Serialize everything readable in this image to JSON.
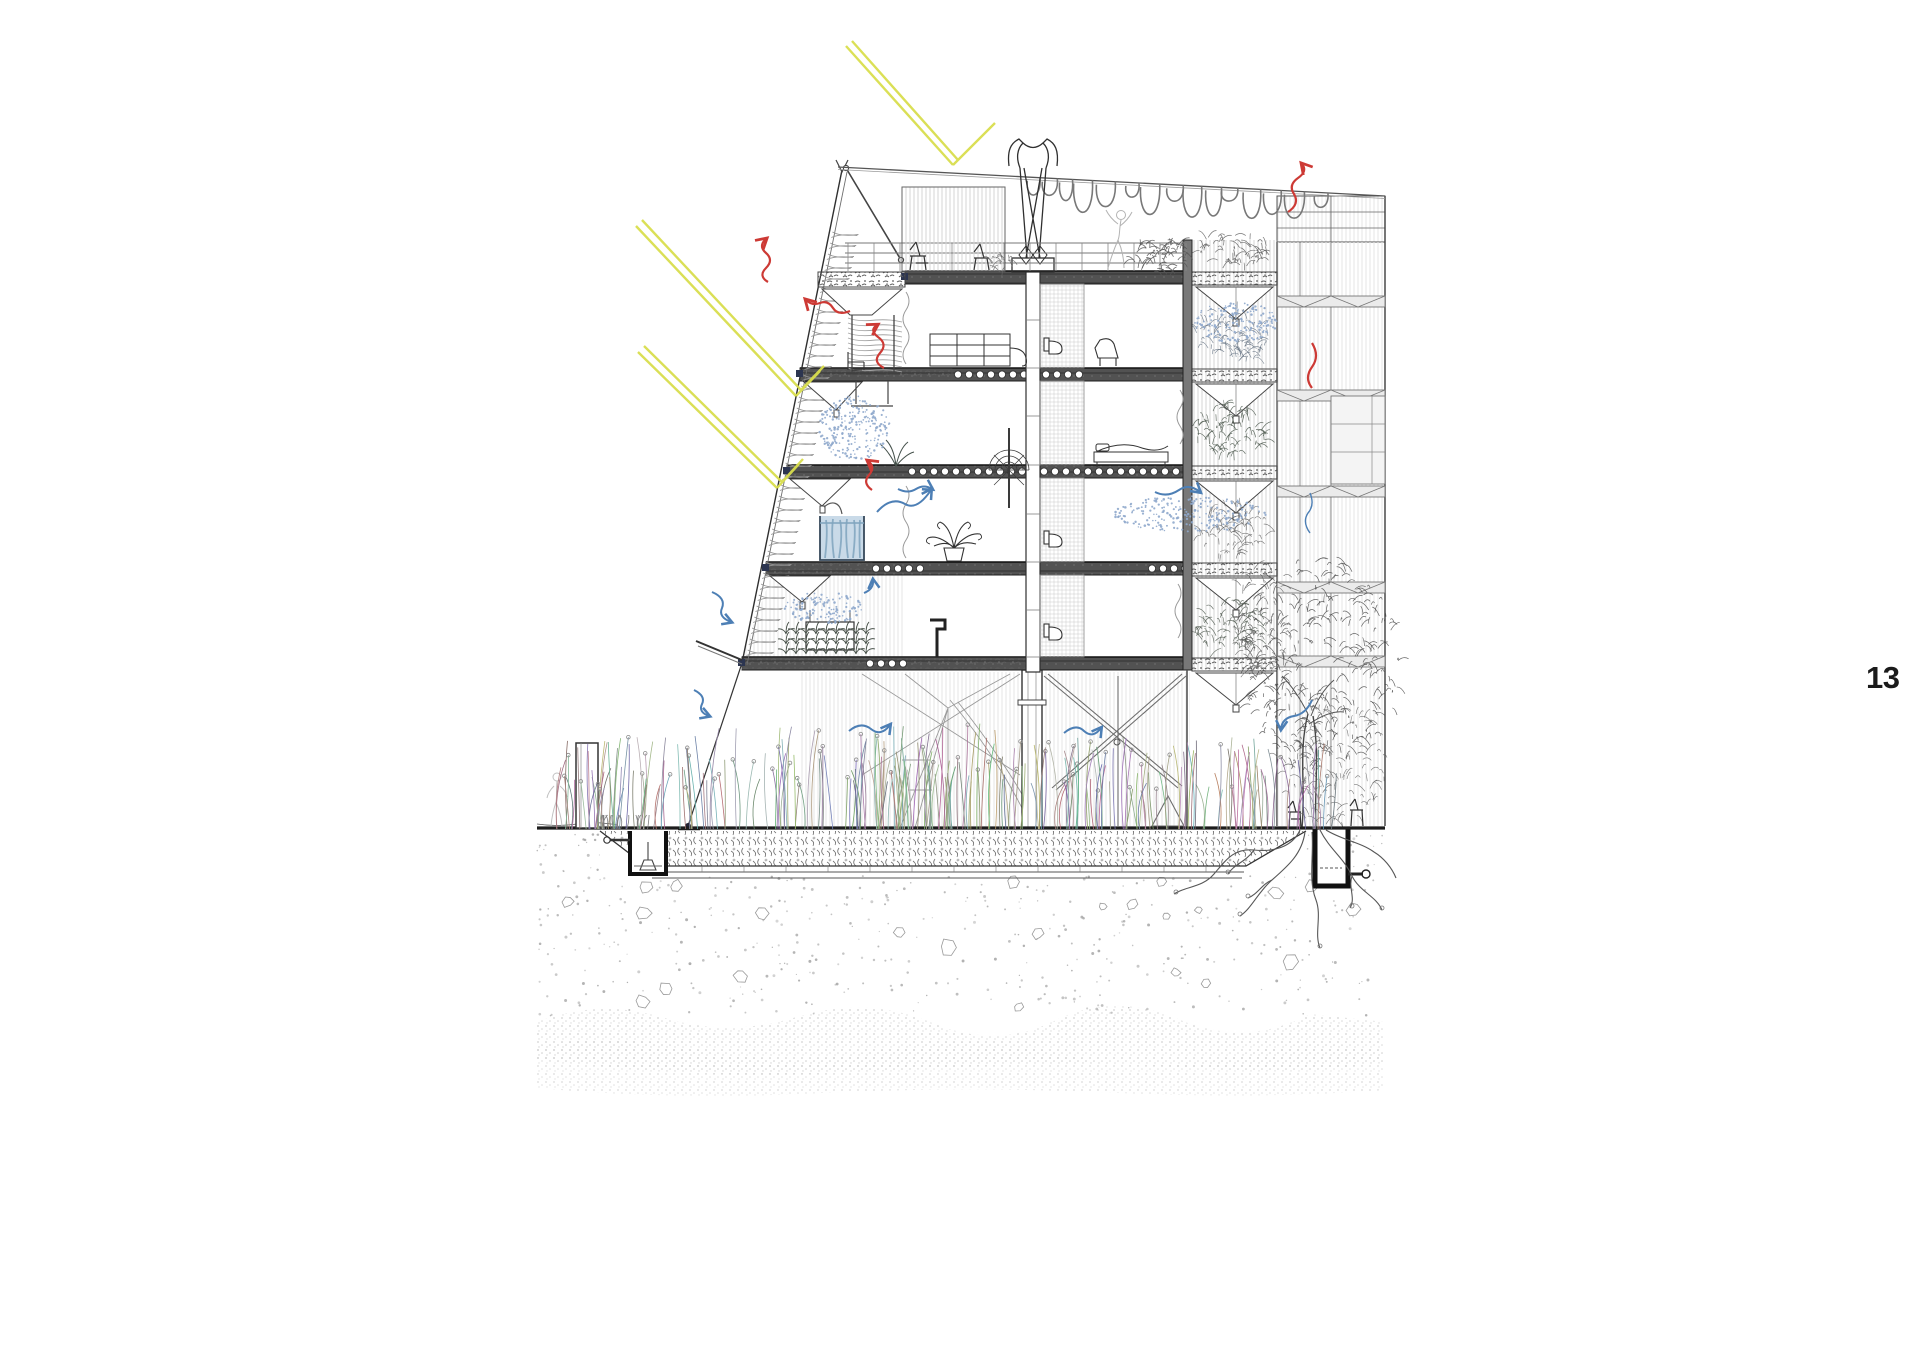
{
  "page": {
    "number": "13",
    "background_color": "#ffffff",
    "number_color": "#1b1b1b"
  },
  "drawing": {
    "name": "architectural-cross-section-bioclimatic-building",
    "type": "section-diagram",
    "floors_above_ground": 4,
    "slab_levels_px": [
      271,
      368,
      465,
      562,
      657
    ],
    "slab_left_edges_px": [
      905,
      800,
      787,
      766,
      742
    ],
    "ground_level_px": 828,
    "palette": {
      "ink": "#2f2f2f",
      "mid": "#6e6e6e",
      "light": "#b5b5b5",
      "sun_ray": "#d9de4d",
      "heat_arrow": "#cd3a35",
      "air_arrow": "#4d7fb5",
      "mist": "#8fa9cc",
      "water": "#c9dae8",
      "water_line": "#7fa3bd",
      "slab": "#4f4f4f",
      "stipple": "#9b9b9b",
      "deep_stratum": "#d2d2d2",
      "vegetation": "#4c4c4c",
      "pagenum": "#1b1b1b"
    },
    "annotations": {
      "sun_rays": {
        "color_key": "sun_ray",
        "count": 3,
        "style": "double-line-with-reflection"
      },
      "heat_arrows": {
        "color_key": "heat_arrow",
        "count": 6,
        "style": "wavy-squiggle-arrow"
      },
      "air_arrows": {
        "color_key": "air_arrow",
        "count": 9,
        "style": "wavy-squiggle-arrow"
      },
      "mist_clouds": {
        "color_key": "mist",
        "count": 4,
        "style": "stipple-cloud"
      }
    },
    "figures": {
      "people": 2,
      "trees": 1,
      "roof_chairs": 2,
      "ground_chairs": 2,
      "water_tanks": 1,
      "wind_chimney": 1,
      "underground_pits": 2
    }
  }
}
